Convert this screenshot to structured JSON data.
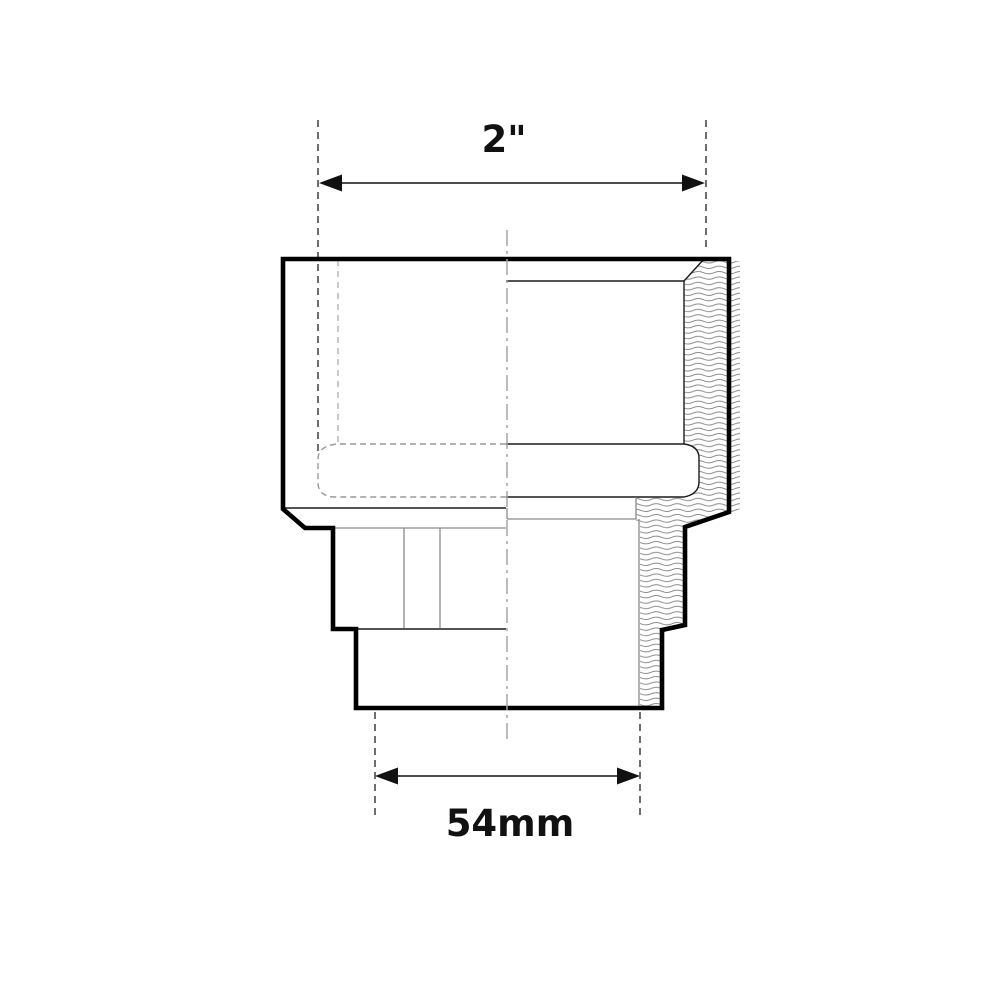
{
  "drawing": {
    "description": "Half-section technical drawing of a pipe adapter fitting, external view on left, sectioned material with wavy hatch on right",
    "dimension_top": {
      "label": "2\"",
      "orientation": "horizontal"
    },
    "dimension_bottom": {
      "label": "54mm",
      "orientation": "horizontal"
    },
    "colors": {
      "background": "#ffffff",
      "outline": "#000000",
      "thin_line": "#1a1a1a",
      "gray_line": "#8a8a8a",
      "hidden_line": "#4a4a4a",
      "hidden_line_light": "#b8b8b8",
      "hidden_capsule": "#999999",
      "centerline": "#a6a6a6",
      "hatch": "#777777",
      "dim_line": "#111111"
    }
  }
}
